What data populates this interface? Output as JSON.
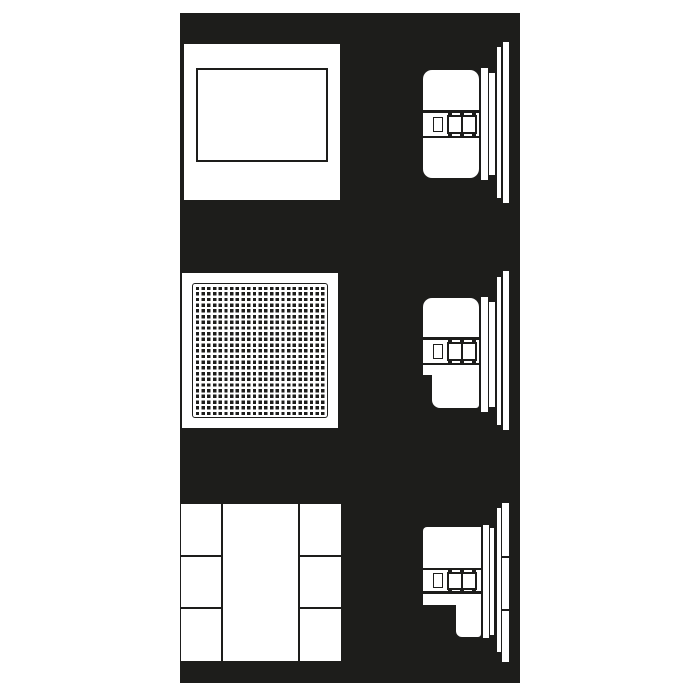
{
  "meta": {
    "description": "Technical installation diagram: three flush-mounted in-wall devices shown as front views (left) and side-profile cross sections (right) on a dark background",
    "text_content": "none"
  },
  "colors": {
    "page_bg": "#ffffff",
    "panel_bg": "#1d1d1b",
    "shape": "#ffffff",
    "line": "#1d1d1b"
  },
  "panel": {
    "x": 180,
    "y": 13,
    "w": 340,
    "h": 670
  },
  "grille_pattern": {
    "pitch": 5.7,
    "gap": 2.3,
    "dot": 3.4
  },
  "rows": [
    {
      "id": "row-1-closed-frame",
      "front": [
        {
          "n": "front-panel",
          "x": 184,
          "y": 44,
          "w": 156,
          "h": 156
        },
        {
          "n": "inner-frame",
          "x": 196,
          "y": 68,
          "w": 132,
          "h": 94,
          "b": 2
        }
      ],
      "side": [
        {
          "n": "device-body",
          "x": 423,
          "y": 70,
          "w": 56,
          "h": 108,
          "r": "9px"
        },
        {
          "n": "band-top-line",
          "x": 423,
          "y": 110,
          "w": 56,
          "h": 2.5,
          "f": "line"
        },
        {
          "n": "band-bottom-line",
          "x": 423,
          "y": 135.5,
          "w": 56,
          "h": 2.5,
          "f": "line"
        },
        {
          "n": "screw-detail",
          "x": 433,
          "y": 116.5,
          "w": 9.5,
          "h": 15,
          "b": 1.8
        },
        {
          "n": "clamp-block",
          "x": 447,
          "y": 114.5,
          "w": 30,
          "h": 19,
          "b": 2
        },
        {
          "n": "clamp-divider",
          "x": 460.5,
          "y": 114.5,
          "w": 2,
          "h": 19,
          "f": "line"
        },
        {
          "n": "clamp-tab",
          "x": 447.5,
          "y": 111.5,
          "w": 4.5,
          "h": 4,
          "f": "line"
        },
        {
          "n": "clamp-tab",
          "x": 459.5,
          "y": 111.5,
          "w": 4.5,
          "h": 4,
          "f": "line"
        },
        {
          "n": "clamp-tab",
          "x": 471.5,
          "y": 111.5,
          "w": 4.5,
          "h": 4,
          "f": "line"
        },
        {
          "n": "clamp-tab",
          "x": 447.5,
          "y": 133,
          "w": 4.5,
          "h": 4,
          "f": "line"
        },
        {
          "n": "clamp-tab",
          "x": 459.5,
          "y": 133,
          "w": 4.5,
          "h": 4,
          "f": "line"
        },
        {
          "n": "clamp-tab",
          "x": 471.5,
          "y": 133,
          "w": 4.5,
          "h": 4,
          "f": "line"
        },
        {
          "n": "mounting-flange",
          "x": 480.5,
          "y": 68,
          "w": 7,
          "h": 112
        },
        {
          "n": "trim-ring-edge",
          "x": 489,
          "y": 73,
          "w": 5.5,
          "h": 102
        },
        {
          "n": "panel-edge-inner",
          "x": 497,
          "y": 47,
          "w": 4,
          "h": 151
        },
        {
          "n": "panel-edge-outer",
          "x": 502.5,
          "y": 42,
          "w": 6,
          "h": 161
        }
      ]
    },
    {
      "id": "row-2-perforated-grille",
      "front": [
        {
          "n": "front-panel",
          "x": 182,
          "y": 273,
          "w": 156,
          "h": 155
        },
        {
          "n": "grille-grid",
          "x": 192,
          "y": 283,
          "w": 136,
          "h": 135,
          "b": 1.6,
          "r": "3px",
          "pat": true
        }
      ],
      "side": [
        {
          "n": "device-body-upper",
          "x": 423,
          "y": 298,
          "w": 56,
          "h": 77,
          "r": "9px 9px 0 0"
        },
        {
          "n": "device-body-lower",
          "x": 432,
          "y": 368,
          "w": 47,
          "h": 40,
          "r": "0 0 3px 8px"
        },
        {
          "n": "band-top-line",
          "x": 423,
          "y": 337,
          "w": 56,
          "h": 2.5,
          "f": "line"
        },
        {
          "n": "band-bottom-line",
          "x": 423,
          "y": 362.5,
          "w": 56,
          "h": 2.5,
          "f": "line"
        },
        {
          "n": "screw-detail",
          "x": 433,
          "y": 343.5,
          "w": 9.5,
          "h": 15,
          "b": 1.8
        },
        {
          "n": "clamp-block",
          "x": 447,
          "y": 341.5,
          "w": 30,
          "h": 19,
          "b": 2
        },
        {
          "n": "clamp-divider",
          "x": 460.5,
          "y": 341.5,
          "w": 2,
          "h": 19,
          "f": "line"
        },
        {
          "n": "clamp-tab",
          "x": 447.5,
          "y": 338.5,
          "w": 4.5,
          "h": 4,
          "f": "line"
        },
        {
          "n": "clamp-tab",
          "x": 459.5,
          "y": 338.5,
          "w": 4.5,
          "h": 4,
          "f": "line"
        },
        {
          "n": "clamp-tab",
          "x": 471.5,
          "y": 338.5,
          "w": 4.5,
          "h": 4,
          "f": "line"
        },
        {
          "n": "clamp-tab",
          "x": 447.5,
          "y": 360,
          "w": 4.5,
          "h": 4,
          "f": "line"
        },
        {
          "n": "clamp-tab",
          "x": 459.5,
          "y": 360,
          "w": 4.5,
          "h": 4,
          "f": "line"
        },
        {
          "n": "clamp-tab",
          "x": 471.5,
          "y": 360,
          "w": 4.5,
          "h": 4,
          "f": "line"
        },
        {
          "n": "mounting-flange",
          "x": 480.5,
          "y": 297,
          "w": 7,
          "h": 115
        },
        {
          "n": "trim-ring-edge",
          "x": 489,
          "y": 302,
          "w": 5.5,
          "h": 105
        },
        {
          "n": "panel-edge-inner",
          "x": 497,
          "y": 277,
          "w": 4,
          "h": 148
        },
        {
          "n": "panel-edge-outer",
          "x": 502.5,
          "y": 271,
          "w": 6,
          "h": 159
        }
      ]
    },
    {
      "id": "row-3-segmented-panels",
      "front": [
        {
          "n": "segment-left-top",
          "x": 181,
          "y": 504,
          "w": 40,
          "h": 51
        },
        {
          "n": "segment-left-middle",
          "x": 181,
          "y": 557,
          "w": 40,
          "h": 50
        },
        {
          "n": "segment-left-bottom",
          "x": 181,
          "y": 609,
          "w": 40,
          "h": 52
        },
        {
          "n": "segment-center",
          "x": 223,
          "y": 504,
          "w": 75,
          "h": 157
        },
        {
          "n": "segment-right-top",
          "x": 300,
          "y": 504,
          "w": 41,
          "h": 51
        },
        {
          "n": "segment-right-middle",
          "x": 300,
          "y": 557,
          "w": 41,
          "h": 50
        },
        {
          "n": "segment-right-bottom",
          "x": 300,
          "y": 609,
          "w": 41,
          "h": 52
        }
      ],
      "side": [
        {
          "n": "device-body-upper",
          "x": 423,
          "y": 527,
          "w": 58,
          "h": 78,
          "r": "4px 0 0 0"
        },
        {
          "n": "device-body-lower",
          "x": 456,
          "y": 598,
          "w": 25,
          "h": 39,
          "r": "0 0 3px 6px"
        },
        {
          "n": "band-top-line",
          "x": 423,
          "y": 567.5,
          "w": 58,
          "h": 2.5,
          "f": "line"
        },
        {
          "n": "band-bottom-line",
          "x": 423,
          "y": 591,
          "w": 58,
          "h": 2.5,
          "f": "line"
        },
        {
          "n": "screw-detail",
          "x": 433,
          "y": 573,
          "w": 9.5,
          "h": 14.5,
          "b": 1.8
        },
        {
          "n": "clamp-block",
          "x": 447,
          "y": 571.5,
          "w": 30,
          "h": 18,
          "b": 2
        },
        {
          "n": "clamp-divider",
          "x": 460.5,
          "y": 571.5,
          "w": 2,
          "h": 18,
          "f": "line"
        },
        {
          "n": "clamp-tab",
          "x": 447.5,
          "y": 568.5,
          "w": 4.5,
          "h": 4,
          "f": "line"
        },
        {
          "n": "clamp-tab",
          "x": 459.5,
          "y": 568.5,
          "w": 4.5,
          "h": 4,
          "f": "line"
        },
        {
          "n": "clamp-tab",
          "x": 471.5,
          "y": 568.5,
          "w": 4.5,
          "h": 4,
          "f": "line"
        },
        {
          "n": "clamp-tab",
          "x": 447.5,
          "y": 588.5,
          "w": 4.5,
          "h": 4,
          "f": "line"
        },
        {
          "n": "clamp-tab",
          "x": 459.5,
          "y": 588.5,
          "w": 4.5,
          "h": 4,
          "f": "line"
        },
        {
          "n": "clamp-tab",
          "x": 471.5,
          "y": 588.5,
          "w": 4.5,
          "h": 4,
          "f": "line"
        },
        {
          "n": "mounting-flange",
          "x": 483,
          "y": 525,
          "w": 5.5,
          "h": 113
        },
        {
          "n": "trim-ring-edge",
          "x": 490,
          "y": 528,
          "w": 4,
          "h": 107
        },
        {
          "n": "panel-edge-inner",
          "x": 496.5,
          "y": 508,
          "w": 4,
          "h": 144
        },
        {
          "n": "panel-edge-outer",
          "x": 502,
          "y": 503,
          "w": 6.5,
          "h": 159
        },
        {
          "n": "panel-seam-line",
          "x": 502,
          "y": 555.5,
          "w": 6.5,
          "h": 2.5,
          "f": "line"
        },
        {
          "n": "panel-seam-line",
          "x": 502,
          "y": 608.5,
          "w": 6.5,
          "h": 2.5,
          "f": "line"
        }
      ]
    }
  ]
}
